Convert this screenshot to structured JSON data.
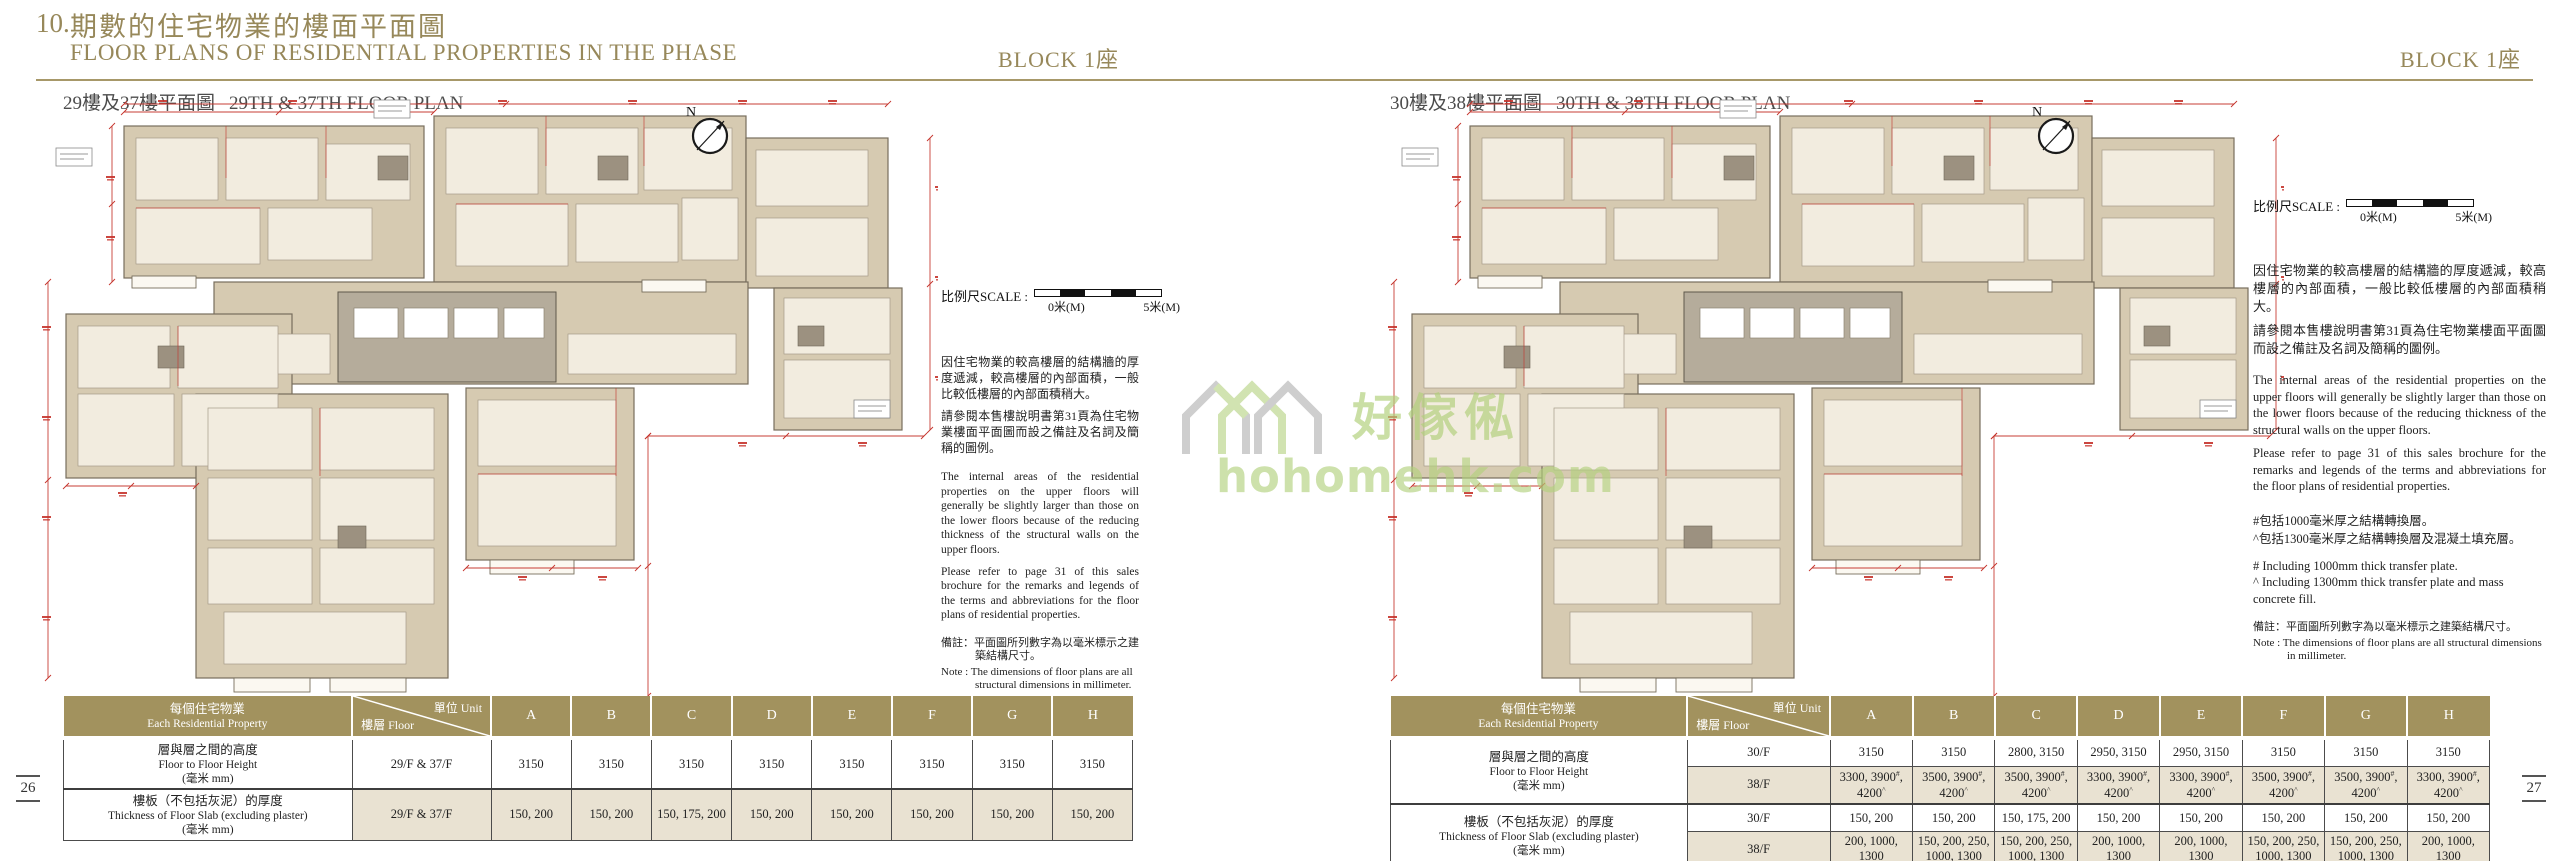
{
  "header": {
    "section_no": "10.",
    "title_zh": "期數的住宅物業的樓面平面圖",
    "title_en": "FLOOR PLANS OF RESIDENTIAL PROPERTIES IN THE PHASE",
    "block_label_left": "BLOCK 1座",
    "block_label_right": "BLOCK 1座"
  },
  "watermark": {
    "text_zh": "好傢俬",
    "text_en": "hohomehk.com"
  },
  "page_numbers": {
    "left": "26",
    "right": "27"
  },
  "colors": {
    "gold": "#97885a",
    "table_header_bg": "#a2925e",
    "shaded_row_bg": "#e9e2d2",
    "plan_mass": "#d6cab1",
    "plan_room": "#f2ecdf",
    "plan_core": "#b5ac9b",
    "plan_line": "#776e5d",
    "dim_red": "#c5332b",
    "watermark_green": "#b2d07c"
  },
  "panels": [
    {
      "subtitle_zh": "29樓及37樓平面圖",
      "subtitle_en": "29TH & 37TH FLOOR PLAN",
      "compass_label": "N",
      "scale_label": "比例尺SCALE :",
      "scale_start": "0米(M)",
      "scale_end": "5米(M)",
      "paragraphs_zh": [
        "因住宅物業的較高樓層的結構牆的厚度遞減，較高樓層的內部面積，一般比較低樓層的內部面積稍大。",
        "請參閱本售樓說明書第31頁為住宅物業樓面平面圖而設之備註及名詞及簡稱的圖例。"
      ],
      "paragraphs_en": [
        "The internal areas of the residential properties on the upper floors will generally be slightly larger than those on the lower floors because of the reducing thickness of the structural walls on the upper floors.",
        "Please refer to page 31 of this sales brochure for the remarks and legends of the terms and abbreviations for the floor plans of residential properties."
      ],
      "footnotes_zh": [],
      "footnotes_en": [],
      "note_zh": "備註：平面圖所列數字為以毫米標示之建築結構尺寸。",
      "note_en": "Note : The dimensions of floor plans are all structural dimensions in millimeter.",
      "table": {
        "header": {
          "property_zh": "每個住宅物業",
          "property_en": "Each Residential Property",
          "unit_label": "單位 Unit",
          "floor_label": "樓層 Floor",
          "units": [
            "A",
            "B",
            "C",
            "D",
            "E",
            "F",
            "G",
            "H"
          ]
        },
        "rows": [
          {
            "label_zh": "層與層之間的高度",
            "label_en": "Floor to Floor Height",
            "label_unit": "(毫米 mm)",
            "floors": [
              {
                "floor": "29/F & 37/F",
                "values": [
                  "3150",
                  "3150",
                  "3150",
                  "3150",
                  "3150",
                  "3150",
                  "3150",
                  "3150"
                ]
              }
            ]
          },
          {
            "label_zh": "樓板（不包括灰泥）的厚度",
            "label_en": "Thickness of Floor Slab (excluding plaster)",
            "label_unit": "(毫米 mm)",
            "floors": [
              {
                "floor": "29/F & 37/F",
                "values": [
                  "150, 200",
                  "150, 200",
                  "150, 175, 200",
                  "150, 200",
                  "150, 200",
                  "150, 200",
                  "150, 200",
                  "150, 200"
                ]
              }
            ]
          }
        ]
      }
    },
    {
      "subtitle_zh": "30樓及38樓平面圖",
      "subtitle_en": "30TH & 38TH FLOOR PLAN",
      "compass_label": "N",
      "scale_label": "比例尺SCALE :",
      "scale_start": "0米(M)",
      "scale_end": "5米(M)",
      "paragraphs_zh": [
        "因住宅物業的較高樓層的結構牆的厚度遞減，較高樓層的內部面積，一般比較低樓層的內部面積稍大。",
        "請參閱本售樓說明書第31頁為住宅物業樓面平面圖而設之備註及名詞及簡稱的圖例。"
      ],
      "paragraphs_en": [
        "The internal areas of the residential properties on the upper floors will generally be slightly larger than those on the lower floors because of the reducing thickness of the structural walls on the upper floors.",
        "Please refer to page 31 of this sales brochure for the remarks and legends of the terms and abbreviations for the floor plans of residential properties."
      ],
      "footnotes_zh": [
        "#包括1000毫米厚之結構轉換層。",
        "^包括1300毫米厚之結構轉換層及混凝土填充層。"
      ],
      "footnotes_en": [
        "# Including 1000mm thick transfer plate.",
        "^ Including 1300mm thick transfer plate and mass concrete fill."
      ],
      "note_zh": "備註：平面圖所列數字為以毫米標示之建築結構尺寸。",
      "note_en": "Note : The dimensions of floor plans are all structural dimensions in millimeter.",
      "table": {
        "header": {
          "property_zh": "每個住宅物業",
          "property_en": "Each Residential Property",
          "unit_label": "單位 Unit",
          "floor_label": "樓層 Floor",
          "units": [
            "A",
            "B",
            "C",
            "D",
            "E",
            "F",
            "G",
            "H"
          ]
        },
        "rows": [
          {
            "label_zh": "層與層之間的高度",
            "label_en": "Floor to Floor Height",
            "label_unit": "(毫米 mm)",
            "floors": [
              {
                "floor": "30/F",
                "values": [
                  "3150",
                  "3150",
                  "2800, 3150",
                  "2950, 3150",
                  "2950, 3150",
                  "3150",
                  "3150",
                  "3150"
                ]
              },
              {
                "floor": "38/F",
                "values": [
                  "3300, 3900#, 4200^",
                  "3500, 3900#, 4200^",
                  "3500, 3900#, 4200^",
                  "3300, 3900#, 4200^",
                  "3300, 3900#, 4200^",
                  "3500, 3900#, 4200^",
                  "3500, 3900#, 4200^",
                  "3300, 3900#, 4200^"
                ]
              }
            ]
          },
          {
            "label_zh": "樓板（不包括灰泥）的厚度",
            "label_en": "Thickness of Floor Slab (excluding plaster)",
            "label_unit": "(毫米 mm)",
            "floors": [
              {
                "floor": "30/F",
                "values": [
                  "150, 200",
                  "150, 200",
                  "150, 175, 200",
                  "150, 200",
                  "150, 200",
                  "150, 200",
                  "150, 200",
                  "150, 200"
                ]
              },
              {
                "floor": "38/F",
                "values": [
                  "200, 1000, 1300",
                  "150, 200, 250, 1000, 1300",
                  "150, 200, 250, 1000, 1300",
                  "200, 1000, 1300",
                  "200, 1000, 1300",
                  "150, 200, 250, 1000, 1300",
                  "150, 200, 250, 1000, 1300",
                  "200, 1000, 1300"
                ]
              }
            ]
          }
        ]
      }
    }
  ]
}
